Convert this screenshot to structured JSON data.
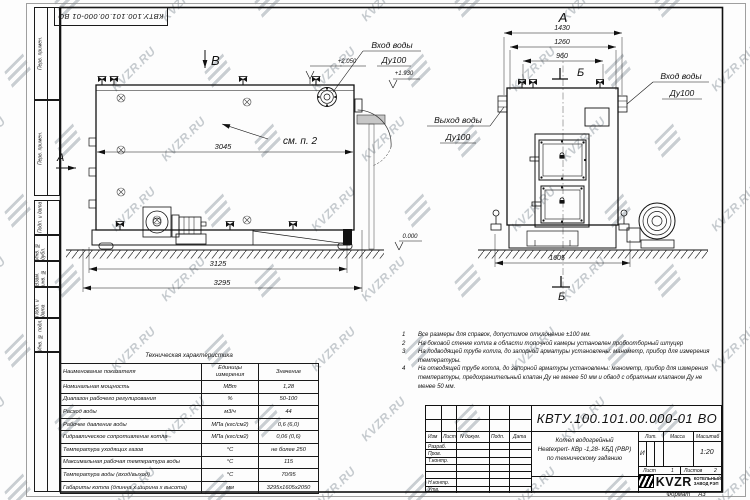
{
  "watermark": {
    "text": "KVZR.RU"
  },
  "top_stamp": "КВТУ.100.101.00.000-01 ВО",
  "frame": {
    "left_labels": [
      "Перв. примен.",
      "Перв. примен.",
      "Подп. и дата",
      "Инв. № дубл.",
      "Взам. инв. №",
      "Подп. и дата",
      "Инв. № подл."
    ]
  },
  "views": {
    "left": {
      "view_label": "В",
      "section_label": "А",
      "see_note": "см. п. 2",
      "dim_inner": "3045",
      "dim_base": "3125",
      "dim_overall": "3295",
      "level_top": "+2.050",
      "level_mid": "+1.930",
      "level_zero": "0.000",
      "inlet_line1": "Вход воды",
      "inlet_line2": "Ду100"
    },
    "right": {
      "view_label": "А",
      "section_label": "Б",
      "dims": [
        "1430",
        "1260",
        "960"
      ],
      "dim_base": "1605",
      "outlet_line1": "Выход воды",
      "outlet_line2": "Ду100",
      "inlet_line1": "Вход воды",
      "inlet_line2": "Ду100"
    }
  },
  "table": {
    "title": "Техническая характеристика",
    "headers": [
      "Наименование показателя",
      "Единицы измерения",
      "Значение"
    ],
    "rows": [
      [
        "Номинальная мощность",
        "МВт",
        "1,28"
      ],
      [
        "Диапазон рабочего регулирования",
        "%",
        "50-100"
      ],
      [
        "Расход воды",
        "м3/ч",
        "44"
      ],
      [
        "Рабочее давление воды",
        "МПа (кгс/см2)",
        "0,6 (6,0)"
      ],
      [
        "Гидравлическое сопротивление котла",
        "МПа (кгс/см2)",
        "0,06 (0,6)"
      ],
      [
        "Температура уходящих газов",
        "°С",
        "не более 250"
      ],
      [
        "Максимальная рабочая температура воды",
        "°С",
        "115"
      ],
      [
        "Температура воды (вход/выход)",
        "°С",
        "70/95"
      ],
      [
        "Габариты котла (длинна х ширина х высота)",
        "мм",
        "3295х1605х2050"
      ]
    ]
  },
  "notes": [
    {
      "num": "1",
      "text": "Все размеры для справок, допустимое отклонение ±100 мм."
    },
    {
      "num": "2",
      "text": "На боковой стенке котла в области топочной камеры установлен пробоотборный штуцер"
    },
    {
      "num": "3",
      "text": "На подводящей трубе котла, до запорной арматуры установлены: манометр, прибор для измерения температуры."
    },
    {
      "num": "4",
      "text": "На отводящей трубе котла, до запорной арматуры установлены: манометр, прибор для измерения температуры, предохранительный клапан Ду не менее 50 мм и обвод с обратным клапаном Ду не менее 50 мм."
    }
  ],
  "title_block": {
    "doc_number": "КВТУ.100.101.00.000-01 ВО",
    "header_cols": [
      "Изм",
      "Лист",
      "N докум.",
      "Подп.",
      "Дата"
    ],
    "row_labels": [
      "Разраб.",
      "Пров.",
      "Т.контр.",
      "Н.контр.",
      "Утв."
    ],
    "name_lines": [
      "Котел водогрейный",
      "Heatexpert- КВр -1,28- КБД (РВР)",
      "по техническому заданию"
    ],
    "lit_label": "Лит.",
    "lit_value": "И",
    "mass_label": "Масса",
    "scale_label": "Масштаб",
    "scale_value": "1:20",
    "sheet_label": "Лист",
    "sheet_value": "1",
    "sheets_label": "Листов",
    "sheets_value": "2",
    "company_abbr": "KVZR",
    "company_line1": "КОТЕЛЬНЫЙ",
    "company_line2": "ЗАВОД РЭП",
    "format_label": "Формат",
    "format_value": "А3"
  }
}
